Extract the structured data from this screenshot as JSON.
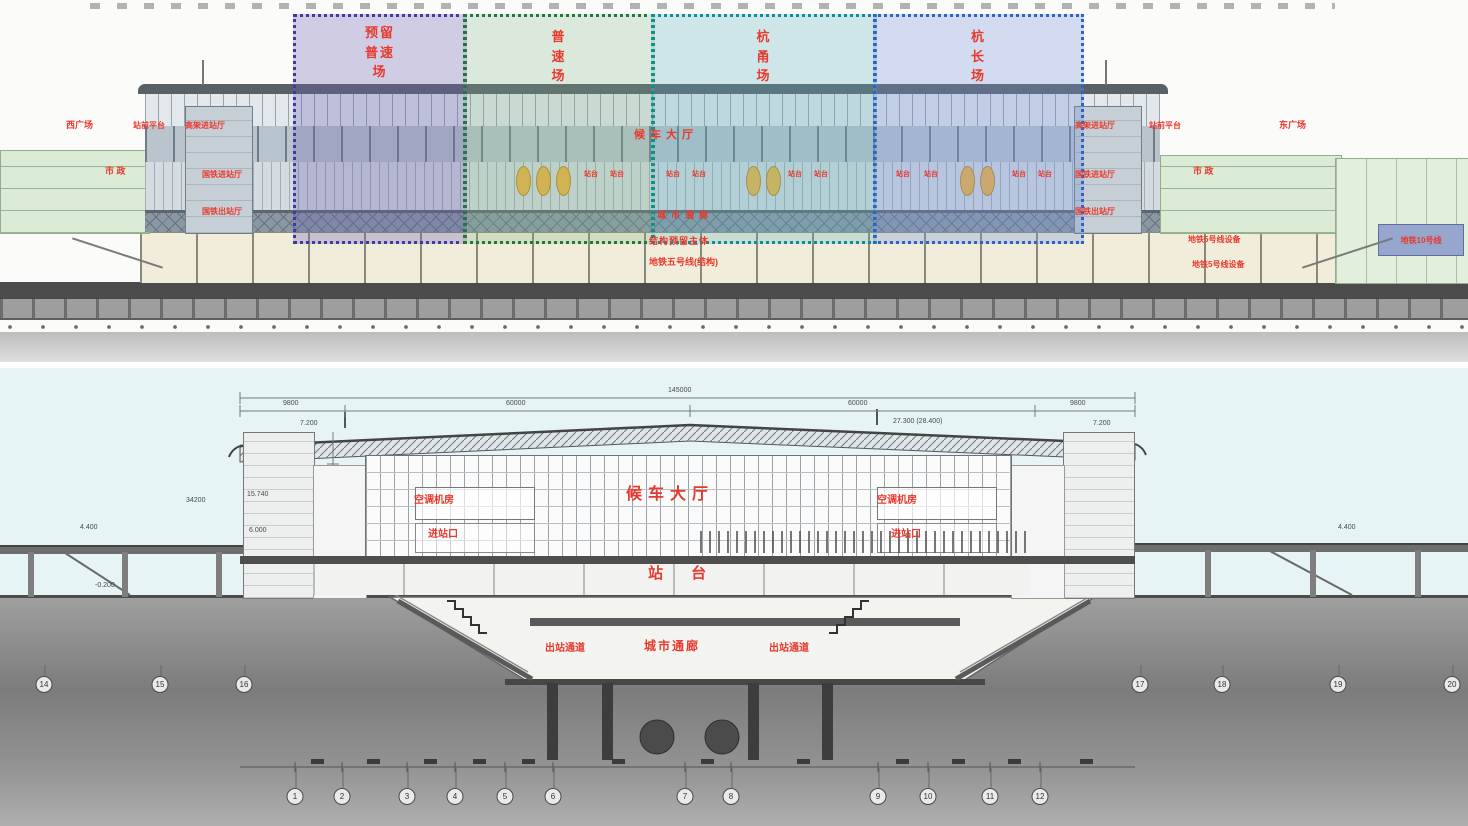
{
  "title": "铁路客站建筑剖面图",
  "colors": {
    "label_red": "#e8392e",
    "dim_grey": "#4a4a4a",
    "zone1_border": "#4336a5",
    "zone2_border": "#1e7a3c",
    "zone3_border": "#0d8e9b",
    "zone4_border": "#2f62c4",
    "sky": "#e7f4f5",
    "ground": "#8f8f8f",
    "cream_band": "#f1edda",
    "green_wing": "#dcebd6",
    "metro_box_blue": "#97a6cd",
    "figure_yellow": "#efb445"
  },
  "top_section": {
    "zones": [
      {
        "label": "预留\n普速\n场"
      },
      {
        "label": "普\n速\n场"
      },
      {
        "label": "杭\n甬\n场"
      },
      {
        "label": "杭\n长\n场"
      }
    ],
    "metro_box_label": "地铁10号线",
    "annotations": [
      {
        "t": "西广场",
        "x": 66,
        "y": 121,
        "s": 9,
        "c": "red"
      },
      {
        "t": "站前平台",
        "x": 133,
        "y": 122,
        "s": 8,
        "c": "red"
      },
      {
        "t": "高架进站厅",
        "x": 185,
        "y": 122,
        "s": 8,
        "c": "red"
      },
      {
        "t": "市 政",
        "x": 105,
        "y": 167,
        "s": 9,
        "c": "red"
      },
      {
        "t": "国铁进站厅",
        "x": 202,
        "y": 171,
        "s": 8,
        "c": "red"
      },
      {
        "t": "国铁出站厅",
        "x": 202,
        "y": 208,
        "s": 8,
        "c": "red"
      },
      {
        "t": "候车大厅",
        "x": 634,
        "y": 130,
        "s": 11,
        "ls": 5,
        "c": "red"
      },
      {
        "t": "城市通廊",
        "x": 657,
        "y": 211,
        "s": 9,
        "ls": 5,
        "c": "red"
      },
      {
        "t": "结构预留主体",
        "x": 649,
        "y": 237,
        "s": 9,
        "ls": 1,
        "c": "red"
      },
      {
        "t": "地铁五号线(结构)",
        "x": 649,
        "y": 258,
        "s": 9,
        "c": "red"
      },
      {
        "t": "高架进站厅",
        "x": 1075,
        "y": 122,
        "s": 8,
        "c": "red"
      },
      {
        "t": "站前平台",
        "x": 1149,
        "y": 122,
        "s": 8,
        "c": "red"
      },
      {
        "t": "东广场",
        "x": 1279,
        "y": 121,
        "s": 9,
        "c": "red"
      },
      {
        "t": "国铁进站厅",
        "x": 1075,
        "y": 171,
        "s": 8,
        "c": "red"
      },
      {
        "t": "市 政",
        "x": 1193,
        "y": 167,
        "s": 9,
        "c": "red"
      },
      {
        "t": "国铁出站厅",
        "x": 1075,
        "y": 208,
        "s": 8,
        "c": "red"
      },
      {
        "t": "地铁5号线设备",
        "x": 1188,
        "y": 236,
        "s": 8,
        "c": "red"
      },
      {
        "t": "地铁5号线设备",
        "x": 1192,
        "y": 261,
        "s": 8,
        "c": "red"
      },
      {
        "t": "站台",
        "x": 584,
        "y": 171,
        "s": 7,
        "c": "red"
      },
      {
        "t": "站台",
        "x": 610,
        "y": 171,
        "s": 7,
        "c": "red"
      },
      {
        "t": "站台",
        "x": 666,
        "y": 171,
        "s": 7,
        "c": "red"
      },
      {
        "t": "站台",
        "x": 692,
        "y": 171,
        "s": 7,
        "c": "red"
      },
      {
        "t": "站台",
        "x": 788,
        "y": 171,
        "s": 7,
        "c": "red"
      },
      {
        "t": "站台",
        "x": 814,
        "y": 171,
        "s": 7,
        "c": "red"
      },
      {
        "t": "站台",
        "x": 896,
        "y": 171,
        "s": 7,
        "c": "red"
      },
      {
        "t": "站台",
        "x": 924,
        "y": 171,
        "s": 7,
        "c": "red"
      },
      {
        "t": "站台",
        "x": 1012,
        "y": 171,
        "s": 7,
        "c": "red"
      },
      {
        "t": "站台",
        "x": 1038,
        "y": 171,
        "s": 7,
        "c": "red"
      }
    ]
  },
  "bottom_section": {
    "annotations": [
      {
        "t": "空调机房",
        "x": 414,
        "y": 128,
        "s": 10,
        "c": "red"
      },
      {
        "t": "进站口",
        "x": 428,
        "y": 162,
        "s": 10,
        "c": "red"
      },
      {
        "t": "候车大厅",
        "x": 626,
        "y": 119,
        "s": 16,
        "ls": 6,
        "c": "red"
      },
      {
        "t": "空调机房",
        "x": 877,
        "y": 128,
        "s": 10,
        "c": "red"
      },
      {
        "t": "进站口",
        "x": 891,
        "y": 162,
        "s": 10,
        "c": "red"
      },
      {
        "t": "站 台",
        "x": 648,
        "y": 198,
        "s": 15,
        "ls": 12,
        "c": "red"
      },
      {
        "t": "出站通道",
        "x": 545,
        "y": 276,
        "s": 10,
        "c": "red"
      },
      {
        "t": "城市通廊",
        "x": 644,
        "y": 272,
        "s": 12,
        "ls": 2,
        "c": "red"
      },
      {
        "t": "出站通道",
        "x": 769,
        "y": 276,
        "s": 10,
        "c": "red"
      },
      {
        "t": "145000",
        "x": 668,
        "y": 19,
        "s": 7,
        "c": "dim"
      },
      {
        "t": "9800",
        "x": 283,
        "y": 32,
        "s": 7,
        "c": "dim"
      },
      {
        "t": "60000",
        "x": 506,
        "y": 32,
        "s": 7,
        "c": "dim"
      },
      {
        "t": "60000",
        "x": 848,
        "y": 32,
        "s": 7,
        "c": "dim"
      },
      {
        "t": "9800",
        "x": 1070,
        "y": 32,
        "s": 7,
        "c": "dim"
      },
      {
        "t": "34200",
        "x": 186,
        "y": 129,
        "s": 7,
        "c": "dim"
      },
      {
        "t": "27.300 (28.400)",
        "x": 893,
        "y": 50,
        "s": 7,
        "c": "dim"
      },
      {
        "t": "7.200",
        "x": 300,
        "y": 52,
        "s": 7,
        "c": "dim"
      },
      {
        "t": "7.200",
        "x": 1093,
        "y": 52,
        "s": 7,
        "c": "dim"
      },
      {
        "t": "15.740",
        "x": 247,
        "y": 123,
        "s": 7,
        "c": "dim"
      },
      {
        "t": "6.000",
        "x": 249,
        "y": 159,
        "s": 7,
        "c": "dim"
      },
      {
        "t": "4.400",
        "x": 80,
        "y": 156,
        "s": 7,
        "c": "dim"
      },
      {
        "t": "-0.200",
        "x": 95,
        "y": 214,
        "s": 7,
        "c": "dim"
      },
      {
        "t": "4.400",
        "x": 1338,
        "y": 156,
        "s": 7,
        "c": "dim"
      }
    ],
    "axes_bottom": [
      {
        "n": "1",
        "x": 295
      },
      {
        "n": "2",
        "x": 342
      },
      {
        "n": "3",
        "x": 407
      },
      {
        "n": "4",
        "x": 455
      },
      {
        "n": "5",
        "x": 505
      },
      {
        "n": "6",
        "x": 553
      },
      {
        "n": "7",
        "x": 685
      },
      {
        "n": "8",
        "x": 731
      },
      {
        "n": "9",
        "x": 878
      },
      {
        "n": "10",
        "x": 928
      },
      {
        "n": "11",
        "x": 990
      },
      {
        "n": "12",
        "x": 1040
      }
    ],
    "axes_left": [
      {
        "n": "14",
        "x": 44
      },
      {
        "n": "15",
        "x": 160
      },
      {
        "n": "16",
        "x": 244
      }
    ],
    "axes_right": [
      {
        "n": "17",
        "x": 1140
      },
      {
        "n": "18",
        "x": 1222
      },
      {
        "n": "19",
        "x": 1338
      },
      {
        "n": "20",
        "x": 1452
      }
    ]
  }
}
